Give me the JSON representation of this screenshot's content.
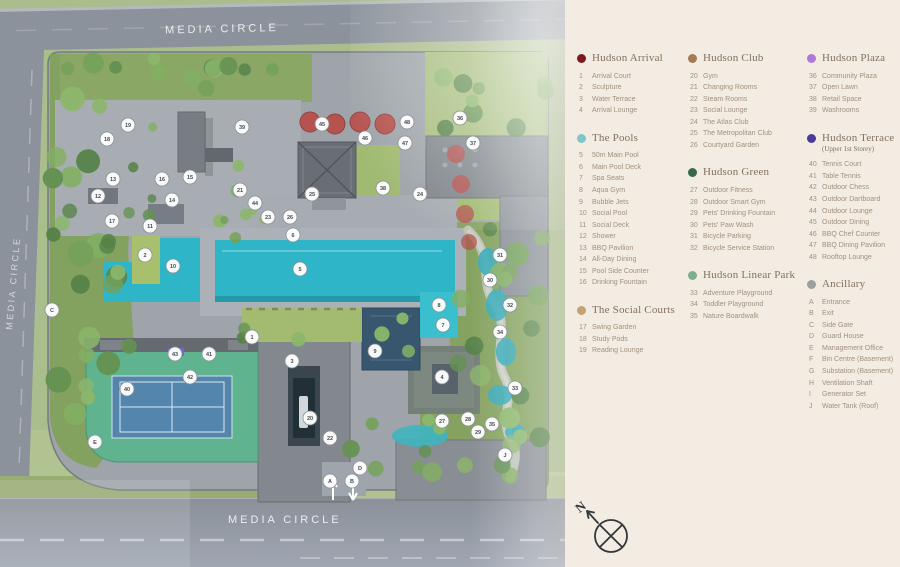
{
  "map": {
    "road_top_label": "MEDIA  CIRCLE",
    "road_bottom_label": "MEDIA  CIRCLE",
    "road_left_label": "MEDIA  CIRCLE",
    "compass_label": "N",
    "colors": {
      "pool": "#23b2c6",
      "pool_dark": "#1795a8",
      "tennis_court": "#4b80a9",
      "tennis_surround": "#57b089",
      "umbrella": "#b24a46",
      "road": "#868d96",
      "grass": "#a6ba86",
      "deck": "#a3a9ae"
    },
    "markers": [
      [
        "1",
        252,
        337
      ],
      [
        "2",
        145,
        255
      ],
      [
        "3",
        292,
        361
      ],
      [
        "4",
        442,
        377
      ],
      [
        "5",
        300,
        269
      ],
      [
        "6",
        293,
        235
      ],
      [
        "7",
        443,
        325
      ],
      [
        "8",
        439,
        305
      ],
      [
        "9",
        375,
        351
      ],
      [
        "10",
        173,
        266
      ],
      [
        "11",
        150,
        226
      ],
      [
        "12",
        98,
        196
      ],
      [
        "13",
        113,
        179
      ],
      [
        "14",
        172,
        200
      ],
      [
        "15",
        190,
        177
      ],
      [
        "16",
        162,
        179
      ],
      [
        "17",
        112,
        221
      ],
      [
        "18",
        107,
        139
      ],
      [
        "19",
        128,
        125
      ],
      [
        "20",
        310,
        418
      ],
      [
        "21",
        240,
        190
      ],
      [
        "22",
        330,
        438
      ],
      [
        "23",
        268,
        217
      ],
      [
        "24",
        420,
        194
      ],
      [
        "25",
        312,
        194
      ],
      [
        "26",
        290,
        217
      ],
      [
        "27",
        442,
        421
      ],
      [
        "28",
        468,
        419
      ],
      [
        "29",
        478,
        432
      ],
      [
        "30",
        490,
        280
      ],
      [
        "31",
        500,
        255
      ],
      [
        "32",
        510,
        305
      ],
      [
        "33",
        515,
        388
      ],
      [
        "34",
        500,
        332
      ],
      [
        "35",
        492,
        424
      ],
      [
        "36",
        460,
        118
      ],
      [
        "37",
        473,
        143
      ],
      [
        "38",
        383,
        188
      ],
      [
        "39",
        242,
        127
      ],
      [
        "40",
        127,
        389
      ],
      [
        "41",
        209,
        354
      ],
      [
        "42",
        190,
        377
      ],
      [
        "43",
        175,
        354
      ],
      [
        "44",
        255,
        203
      ],
      [
        "45",
        322,
        124
      ],
      [
        "46",
        365,
        138
      ],
      [
        "47",
        405,
        143
      ],
      [
        "48",
        407,
        122
      ],
      [
        "A",
        330,
        481
      ],
      [
        "B",
        352,
        481
      ],
      [
        "C",
        52,
        310
      ],
      [
        "D",
        360,
        468
      ],
      [
        "E",
        95,
        442
      ],
      [
        "J",
        505,
        455
      ]
    ]
  },
  "legend": {
    "columns": [
      [
        {
          "title": "Hudson Arrival",
          "color": "#7d1a1c",
          "items": [
            [
              "1",
              "Arrival Court"
            ],
            [
              "2",
              "Sculpture"
            ],
            [
              "3",
              "Water Terrace"
            ],
            [
              "4",
              "Arrival Lounge"
            ]
          ]
        },
        {
          "title": "The Pools",
          "color": "#7ec5ce",
          "items": [
            [
              "5",
              "50m Main Pool"
            ],
            [
              "6",
              "Main Pool Deck"
            ],
            [
              "7",
              "Spa Seats"
            ],
            [
              "8",
              "Aqua Gym"
            ],
            [
              "9",
              "Bubble Jets"
            ],
            [
              "10",
              "Social Pool"
            ],
            [
              "11",
              "Social Deck"
            ],
            [
              "12",
              "Shower"
            ],
            [
              "13",
              "BBQ Pavilion"
            ],
            [
              "14",
              "All-Day Dining"
            ],
            [
              "15",
              "Pool Side Counter"
            ],
            [
              "16",
              "Drinking Fountain"
            ]
          ]
        },
        {
          "title": "The Social Courts",
          "color": "#c6a171",
          "items": [
            [
              "17",
              "Swing Garden"
            ],
            [
              "18",
              "Study Pods"
            ],
            [
              "19",
              "Reading Lounge"
            ]
          ]
        }
      ],
      [
        {
          "title": "Hudson Club",
          "color": "#a67a52",
          "items": [
            [
              "20",
              "Gym"
            ],
            [
              "21",
              "Changing Rooms"
            ],
            [
              "22",
              "Steam Rooms"
            ],
            [
              "23",
              "Social Lounge"
            ],
            [
              "24",
              "The Atlas Club"
            ],
            [
              "25",
              "The Metropolitan Club"
            ],
            [
              "26",
              "Courtyard Garden"
            ]
          ]
        },
        {
          "title": "Hudson Green",
          "color": "#36684f",
          "items": [
            [
              "27",
              "Outdoor Fitness"
            ],
            [
              "28",
              "Outdoor Smart Gym"
            ],
            [
              "29",
              "Pets' Drinking Fountain"
            ],
            [
              "30",
              "Pets' Paw Wash"
            ],
            [
              "31",
              "Bicycle Parking"
            ],
            [
              "32",
              "Bicycle Service Station"
            ]
          ]
        },
        {
          "title": "Hudson Linear Park",
          "color": "#7bae8d",
          "items": [
            [
              "33",
              "Adventure Playground"
            ],
            [
              "34",
              "Toddler Playground"
            ],
            [
              "35",
              "Nature Boardwalk"
            ]
          ]
        }
      ],
      [
        {
          "title": "Hudson Plaza",
          "color": "#ad79d9",
          "items": [
            [
              "36",
              "Community Plaza"
            ],
            [
              "37",
              "Open Lawn"
            ],
            [
              "38",
              "Retail Space"
            ],
            [
              "39",
              "Washrooms"
            ]
          ]
        },
        {
          "title": "Hudson Terrace",
          "subtitle": "(Upper 1st Storey)",
          "color": "#4a3b99",
          "items": [
            [
              "40",
              "Tennis Court"
            ],
            [
              "41",
              "Table Tennis"
            ],
            [
              "42",
              "Outdoor Chess"
            ],
            [
              "43",
              "Outdoor Dartboard"
            ],
            [
              "44",
              "Outdoor Lounge"
            ],
            [
              "45",
              "Outdoor Dining"
            ],
            [
              "46",
              "BBQ Chef Counter"
            ],
            [
              "47",
              "BBQ Dining Pavilion"
            ],
            [
              "48",
              "Rooftop Lounge"
            ]
          ]
        },
        {
          "title": "Ancillary",
          "color": "#9ba19d",
          "items": [
            [
              "A",
              "Entrance"
            ],
            [
              "B",
              "Exit"
            ],
            [
              "C",
              "Side Gate"
            ],
            [
              "D",
              "Guard House"
            ],
            [
              "E",
              "Management Office"
            ],
            [
              "F",
              "Bin Centre (Basement)"
            ],
            [
              "G",
              "Substation (Basement)"
            ],
            [
              "H",
              "Ventilation Shaft"
            ],
            [
              "I",
              "Generator Set"
            ],
            [
              "J",
              "Water Tank (Roof)"
            ]
          ]
        }
      ]
    ]
  }
}
